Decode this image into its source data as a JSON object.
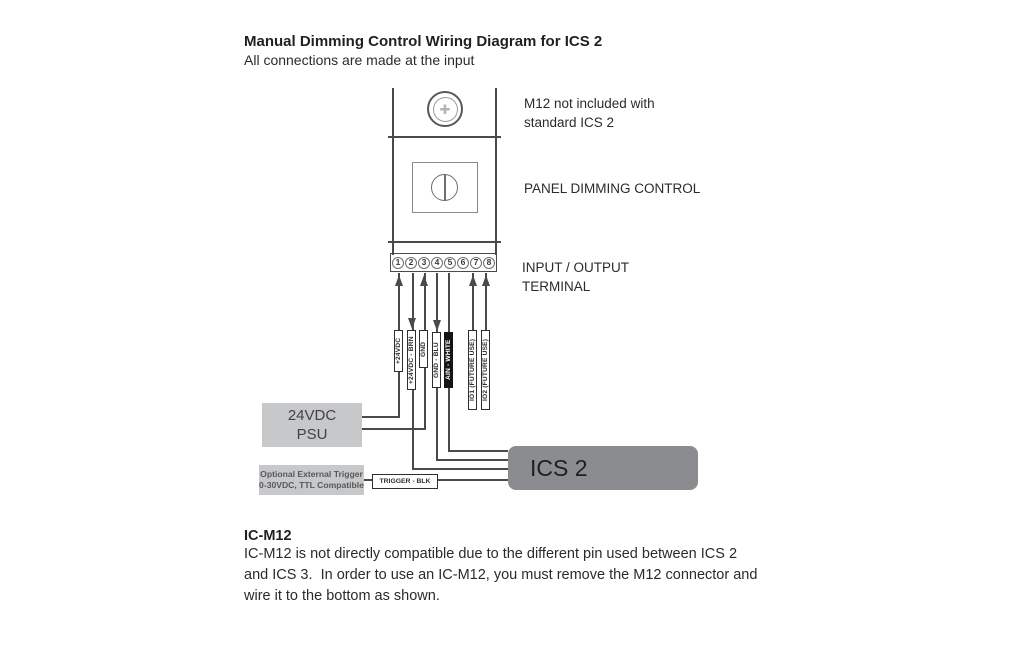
{
  "header": {
    "title": "Manual Dimming Control Wiring Diagram for ICS 2",
    "subtitle": "All connections are made at the input"
  },
  "device": {
    "m12_note_line1": "M12 not included with",
    "m12_note_line2": "standard ICS 2",
    "panel_label": "PANEL DIMMING CONTROL",
    "terminal_label_line1": "INPUT / OUTPUT",
    "terminal_label_line2": "TERMINAL",
    "terminals": [
      "1",
      "2",
      "3",
      "4",
      "5",
      "6",
      "7",
      "8"
    ]
  },
  "icons": {
    "m12_pins_icon": "✚"
  },
  "wires": {
    "w1": "+24VDC",
    "w2": "+24VDC - BRN",
    "w3": "GND",
    "w4": "GND - BLU",
    "w5": "AIN - WHITE",
    "w7": "IO1 (FUTURE USE)",
    "w8": "IO2 (FUTURE USE)",
    "trigger": "TRIGGER - BLK"
  },
  "psu": {
    "line1": "24VDC",
    "line2": "PSU"
  },
  "trigger_box": {
    "line1": "Optional External Trigger",
    "line2": "0-30VDC, TTL Compatible"
  },
  "ics": {
    "label": "ICS 2"
  },
  "footer": {
    "heading": "IC-M12",
    "line1": "IC-M12 is not directly compatible due to the different pin used between ICS 2",
    "line2": "and ICS 3.  In order to use an IC-M12, you must remove the M12 connector and",
    "line3": "wire it to the bottom as shown."
  },
  "colors": {
    "line": "#4a4a4c",
    "light_box": "#c7c8ca",
    "ics_box": "#8a8c8f",
    "label_dark_bg": "#151517",
    "text": "#231f20"
  }
}
